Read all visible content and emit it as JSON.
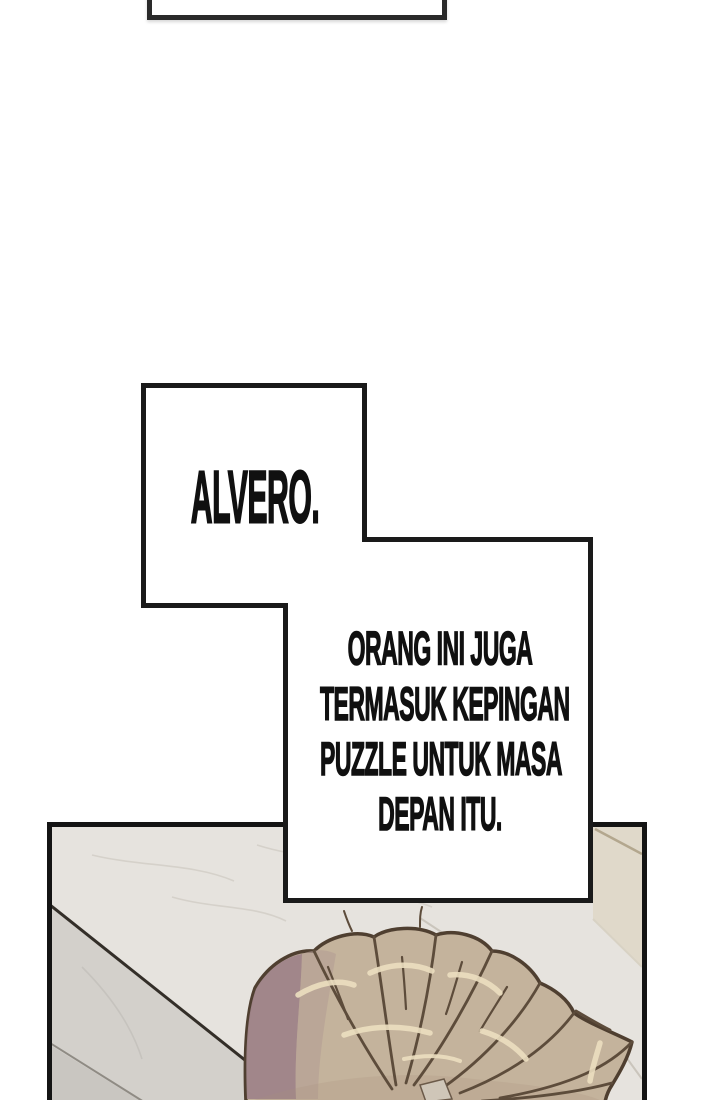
{
  "comic": {
    "top_speech_box": {
      "text": ""
    },
    "speech_alvero": {
      "text": "ALVERO."
    },
    "speech_puzzle": {
      "lines": [
        "ORANG INI JUGA",
        "TERMASUK KEPINGAN",
        "PUZZLE UNTUK MASA",
        "DEPAN ITU."
      ]
    }
  },
  "colors": {
    "page_bg": "#ffffff",
    "speech_fill": "#ffffff",
    "speech_border": "#1a1a1a",
    "panel_border": "#141414",
    "text_color": "#101010",
    "floor_light": "#e6e3de",
    "floor_step": "#d3d0cb",
    "floor_step_dark": "#c9c6c1",
    "tile_beige": "#e0d9ca",
    "tile_seam": "#b3a78e",
    "hair_base": "#c4b39c",
    "hair_shadow": "#9f8489",
    "hair_line": "#5d4c3b",
    "hair_outline": "#4f3f30",
    "hair_highlight": "#ecdfc0"
  }
}
